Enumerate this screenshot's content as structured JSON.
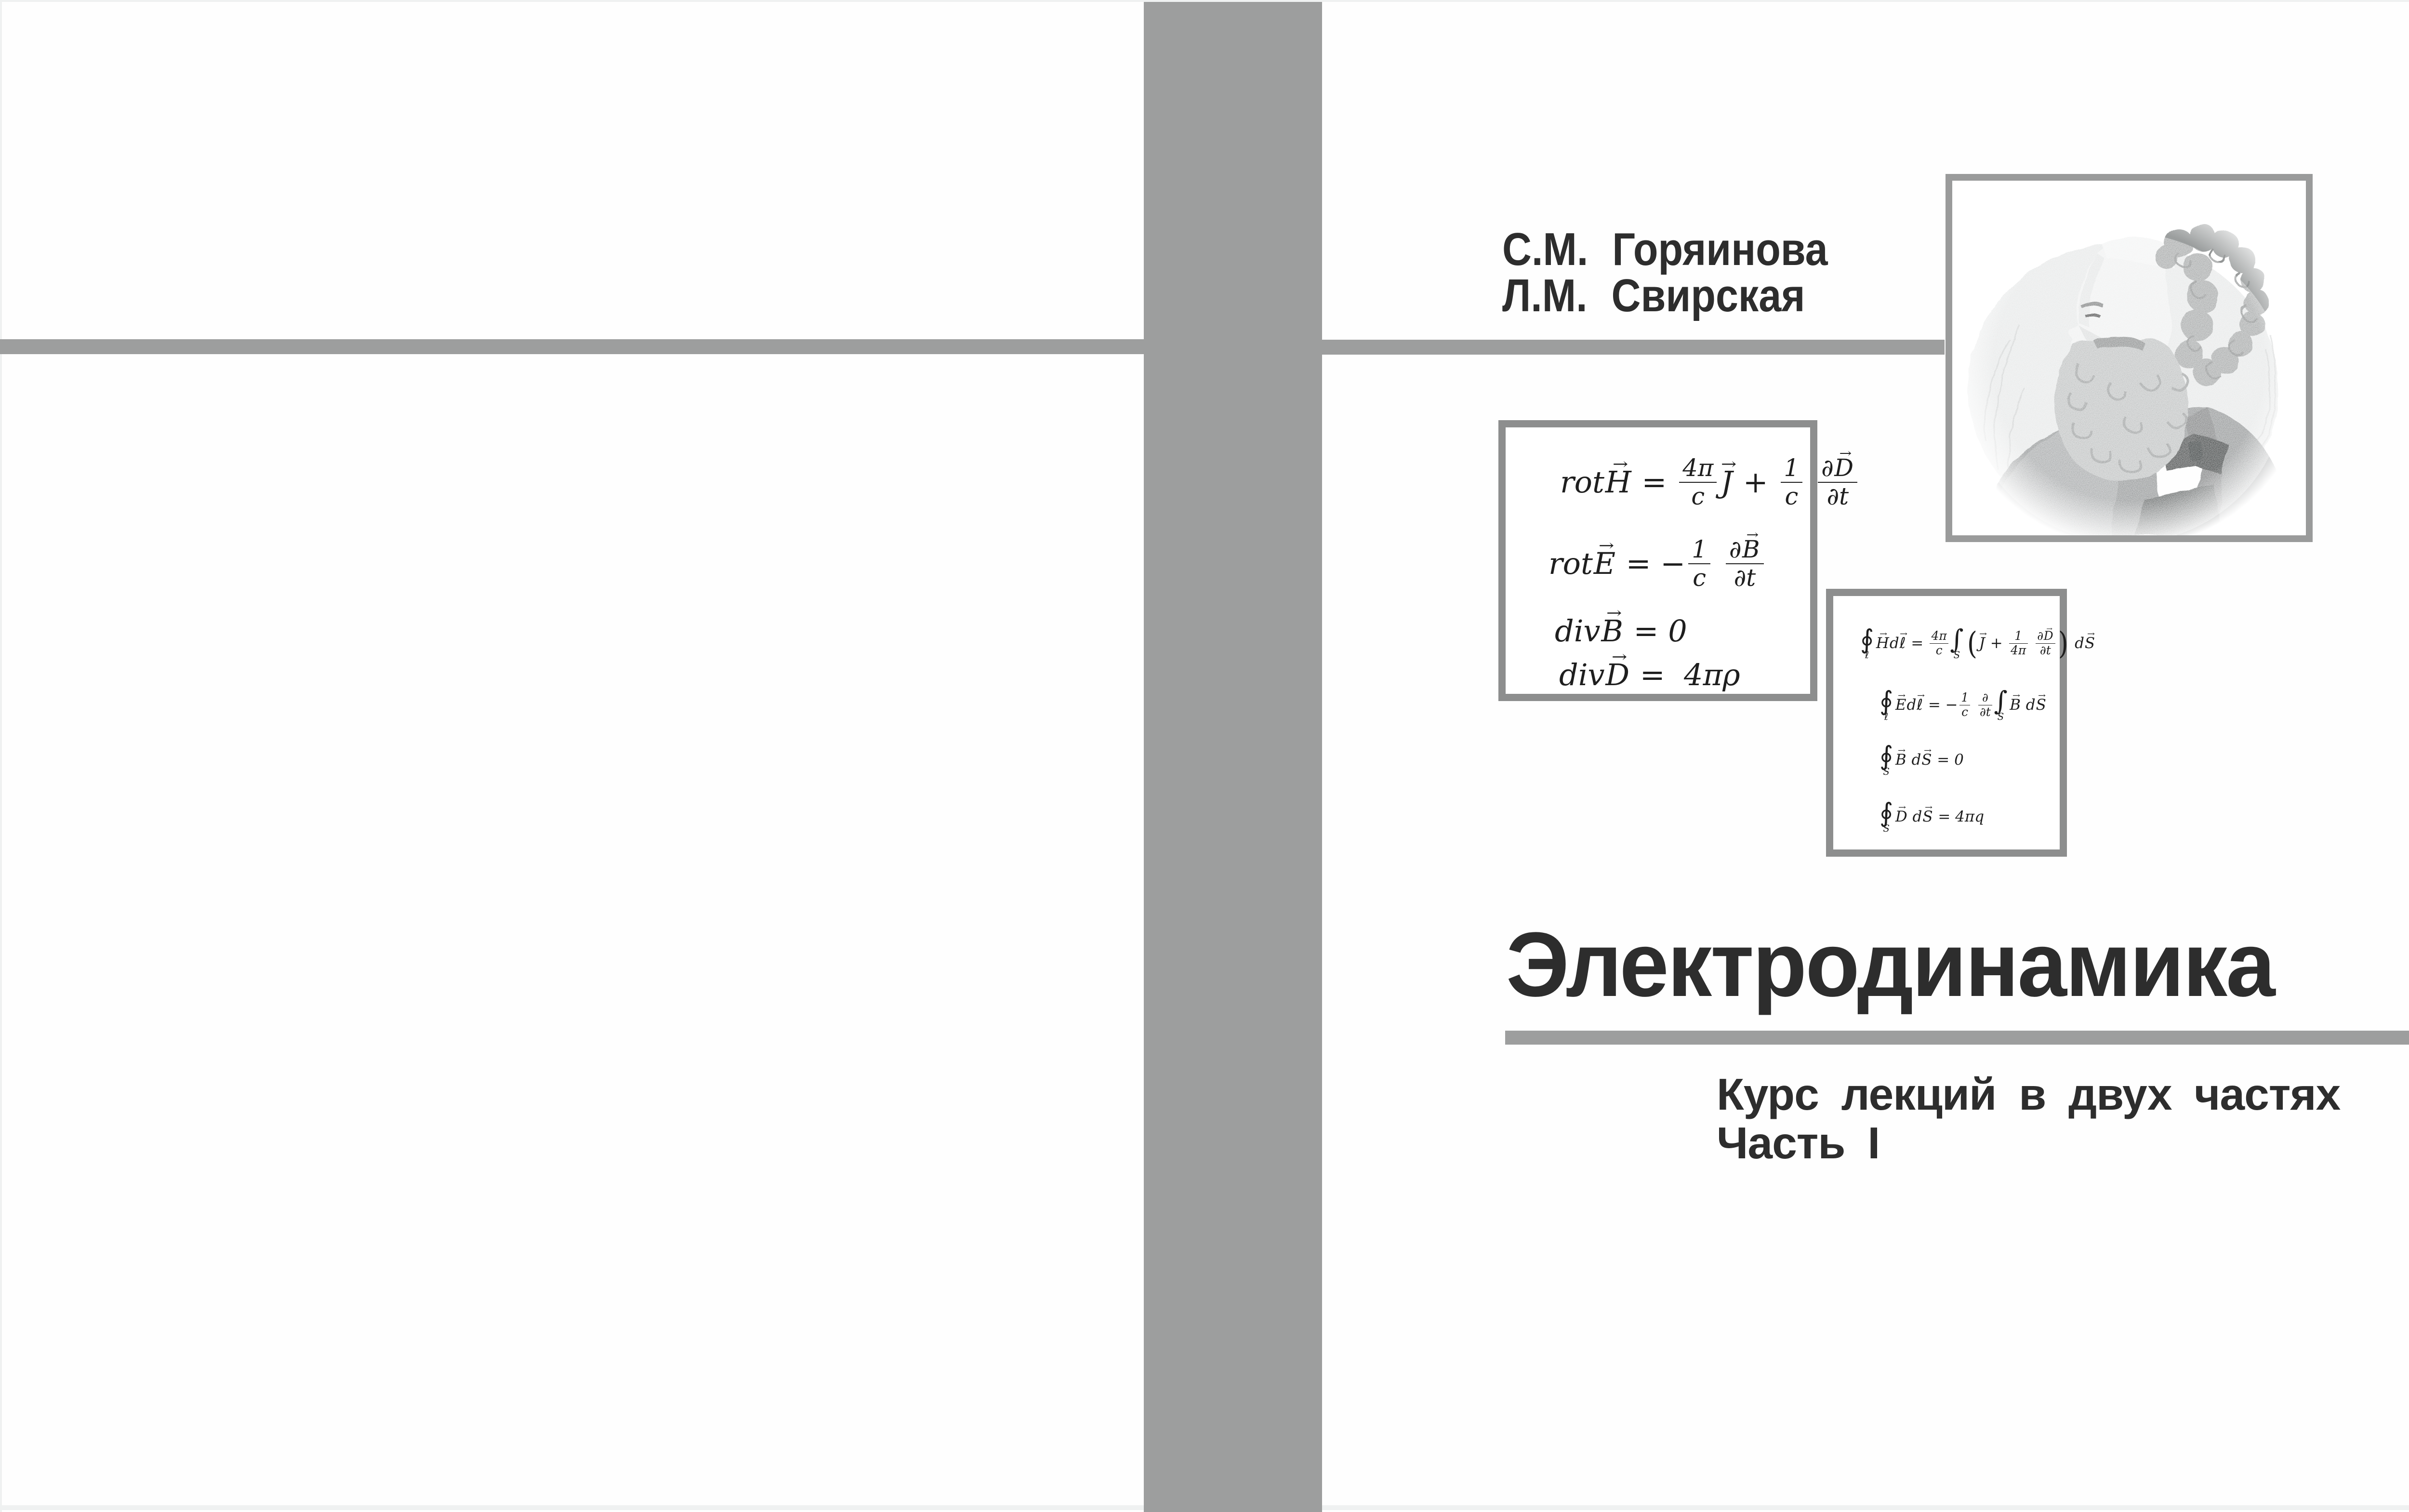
{
  "colors": {
    "bar_gray": "#9d9e9e",
    "box_border_gray": "#8d8e8e",
    "frame_gray": "#9a9b9b",
    "text_dark": "#2d2d2d",
    "scan_edge": "#eff1f1"
  },
  "front_cover": {
    "authors": {
      "line1": "С.М. Горяинова",
      "line2": "Л.М. Свирская"
    },
    "title": "Электродинамика",
    "subtitle": {
      "line1": "Курс лекций в двух частях",
      "line2": "Часть I"
    },
    "portrait_alt": "maxwell-engraving"
  },
  "equations": {
    "differential": [
      [
        "rot",
        {
          "vec": "H"
        },
        " = ",
        {
          "frac": {
            "n": [
              "4π"
            ],
            "d": [
              "c"
            ]
          }
        },
        {
          "vec": "J"
        },
        " + ",
        {
          "frac": {
            "n": [
              "1"
            ],
            "d": [
              "c"
            ]
          }
        },
        " ",
        {
          "frac": {
            "n": [
              "∂",
              {
                "vec": "D"
              }
            ],
            "d": [
              "∂t"
            ]
          }
        }
      ],
      [
        "rot",
        {
          "vec": "E"
        },
        " = −",
        {
          "frac": {
            "n": [
              "1"
            ],
            "d": [
              "c"
            ]
          }
        },
        " ",
        {
          "frac": {
            "n": [
              "∂",
              {
                "vec": "B"
              }
            ],
            "d": [
              "∂t"
            ]
          }
        }
      ],
      [
        "div",
        {
          "vec": "B"
        },
        " = 0"
      ],
      [
        "div",
        {
          "vec": "D"
        },
        " =  4πρ"
      ]
    ],
    "integral": [
      [
        {
          "big": "∮",
          "sub": "ℓ"
        },
        {
          "vec": "H"
        },
        "d",
        {
          "vec": "ℓ"
        },
        " = ",
        {
          "frac": {
            "n": [
              "4π"
            ],
            "d": [
              "c"
            ]
          }
        },
        {
          "big": "∫",
          "sub": "S"
        },
        {
          "par": "("
        },
        {
          "vec": "J"
        },
        " + ",
        {
          "frac": {
            "n": [
              "1"
            ],
            "d": [
              "4π"
            ]
          }
        },
        " ",
        {
          "frac": {
            "n": [
              "∂",
              {
                "vec": "D"
              }
            ],
            "d": [
              "∂t"
            ]
          }
        },
        {
          "par": ")"
        },
        " d",
        {
          "vec": "S"
        }
      ],
      [
        {
          "big": "∮",
          "sub": "ℓ"
        },
        {
          "vec": "E"
        },
        "d",
        {
          "vec": "ℓ"
        },
        " = −",
        {
          "frac": {
            "n": [
              "1"
            ],
            "d": [
              "c"
            ]
          }
        },
        " ",
        {
          "frac": {
            "n": [
              "∂"
            ],
            "d": [
              "∂t"
            ]
          }
        },
        {
          "big": "∫",
          "sub": "S"
        },
        {
          "vec": "B"
        },
        " d",
        {
          "vec": "S"
        }
      ],
      [
        {
          "big": "∮",
          "sub": "S"
        },
        {
          "vec": "B"
        },
        " d",
        {
          "vec": "S"
        },
        " = 0"
      ],
      [
        {
          "big": "∮",
          "sub": "S"
        },
        {
          "vec": "D"
        },
        " d",
        {
          "vec": "S"
        },
        " = 4πq"
      ]
    ]
  }
}
